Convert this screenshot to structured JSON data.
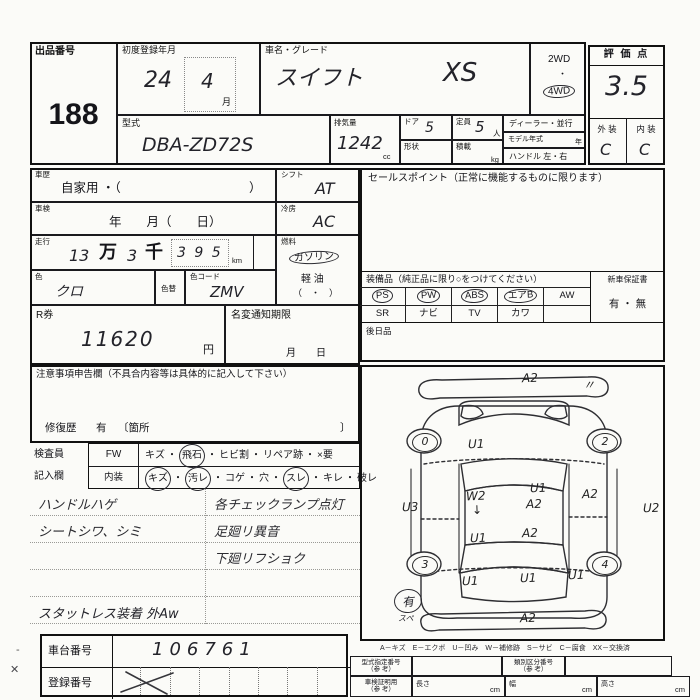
{
  "header": {
    "lot_label": "出品番号",
    "lot_number": "188",
    "first_reg_label": "初度登録年月",
    "first_reg_year": "24",
    "first_reg_month": "4",
    "month_suffix": "月",
    "name_grade_label": "車名・グレード",
    "car_name": "スイフト",
    "grade": "XS",
    "drive_2wd": "2WD",
    "drive_dot": "・",
    "drive_4wd": "4WD",
    "model_code_label": "型式",
    "model_code": "DBA-ZD72S",
    "displacement_label": "排気量",
    "displacement": "1242",
    "displacement_unit": "cc",
    "doors_label": "ドア",
    "doors": "5",
    "shape_label": "形状",
    "capacity_label": "定員",
    "capacity": "5",
    "capacity_unit": "人",
    "load_label": "積載",
    "load_unit": "kg",
    "dealer_label": "ディーラー・並行",
    "model_year_label": "モデル年式",
    "model_year_unit": "年",
    "handle_label": "ハンドル 左・右"
  },
  "score": {
    "title": "評 価 点",
    "value": "3.5",
    "exterior_label": "外 装",
    "interior_label": "内 装",
    "exterior": "C",
    "interior": "C"
  },
  "left": {
    "history_label": "車歴",
    "history_value": "自家用 ・（",
    "history_close": "）",
    "shaken_label": "車検",
    "shaken_value": "年　　月（　　日）",
    "mileage_label": "走行",
    "mileage_man": "13",
    "man_unit": "万",
    "mileage_sen": "3",
    "sen_unit": "千",
    "mileage_rest": "3 9 5",
    "km_unit": "km",
    "color_label": "色",
    "color_value": "クロ",
    "recolor_label": "色替",
    "color_code_label": "色コード",
    "color_code": "ZMV",
    "shift_label": "シフト",
    "shift_value": "AT",
    "ac_label": "冷房",
    "ac_value": "AC",
    "fuel_label": "燃料",
    "fuel_gasoline": "ガソリン",
    "fuel_diesel": "軽 油",
    "fuel_other": "（　・　）",
    "rticket_label": "R券",
    "rticket_value": "11620",
    "yen_unit": "円",
    "namechange_label": "名変通知期限",
    "namechange_value": "月　　日"
  },
  "sales": {
    "title": "セールスポイント（正常に機能するものに限ります）",
    "equipment_title": "装備品（純正品に限り○をつけてください）",
    "equipment_rows": [
      [
        {
          "label": "PS",
          "circled": true
        },
        {
          "label": "PW",
          "circled": true
        },
        {
          "label": "ABS",
          "circled": true
        },
        {
          "label": "エアB",
          "circled": true
        },
        {
          "label": "AW",
          "circled": false
        }
      ],
      [
        {
          "label": "SR",
          "circled": false
        },
        {
          "label": "ナビ",
          "circled": false
        },
        {
          "label": "TV",
          "circled": false
        },
        {
          "label": "カワ",
          "circled": false
        },
        {
          "label": "",
          "circled": false
        }
      ]
    ],
    "warranty_label": "新車保証書",
    "warranty_value": "有 ・ 無",
    "later_goods_label": "後日品"
  },
  "notice": {
    "title": "注意事項申告欄（不具合内容等は具体的に記入して下さい）",
    "repair_label": "修復歴",
    "repair_value": "有",
    "repair_open": "〔箇所",
    "repair_close": "〕"
  },
  "inspection": {
    "separator": "・",
    "row1_label": "検査員",
    "row1_key": "FW",
    "row1_items": [
      {
        "label": "キズ",
        "circled": false
      },
      {
        "label": "飛石",
        "circled": true
      },
      {
        "label": "ヒビ割",
        "circled": false
      },
      {
        "label": "リペア跡",
        "circled": false
      },
      {
        "label": "×要",
        "circled": false
      }
    ],
    "row2_label": "記入欄",
    "row2_key": "内装",
    "row2_items": [
      {
        "label": "キズ",
        "circled": true
      },
      {
        "label": "汚レ",
        "circled": true
      },
      {
        "label": "コゲ",
        "circled": false
      },
      {
        "label": "穴",
        "circled": false
      },
      {
        "label": "スレ",
        "circled": true
      },
      {
        "label": "キレ",
        "circled": false
      },
      {
        "label": "破レ",
        "circled": false
      }
    ]
  },
  "notes": {
    "left": [
      "ハンドルハゲ",
      "シートシワ、シミ"
    ],
    "right": [
      "各チェックランプ点灯",
      "足廻リ異音",
      "下廻リフショク"
    ],
    "tires": "スタットレス装着 外Aw"
  },
  "bottom": {
    "chassis_label": "車台番号",
    "chassis_value": "106761",
    "reg_label": "登録番号",
    "legend": "A－キズ　E－エクボ　U－凹み　W－補修跡　S－サビ　C－腐食　XX－交換済",
    "type_no_label": "型式指定番号",
    "class_no_label": "類別区分番号",
    "cert_label": "車検証明用",
    "ref_label": "（参 考）",
    "length_label": "長さ",
    "width_label": "幅",
    "height_label": "高さ",
    "cm_unit": "cm"
  },
  "margin": {
    "dash": "-",
    "cross": "✕"
  },
  "diagram": {
    "marks": [
      {
        "t": "A2",
        "x": 160,
        "y": 4
      },
      {
        "t": "〃",
        "x": 221,
        "y": 9
      },
      {
        "t": "U1",
        "x": 106,
        "y": 70
      },
      {
        "t": "U3",
        "x": 40,
        "y": 133
      },
      {
        "t": "W2",
        "x": 104,
        "y": 122
      },
      {
        "t": "↓",
        "x": 110,
        "y": 136
      },
      {
        "t": "U1",
        "x": 168,
        "y": 114
      },
      {
        "t": "A2",
        "x": 164,
        "y": 130
      },
      {
        "t": "A2",
        "x": 220,
        "y": 120
      },
      {
        "t": "U2",
        "x": 281,
        "y": 134
      },
      {
        "t": "U1",
        "x": 108,
        "y": 164
      },
      {
        "t": "A2",
        "x": 160,
        "y": 159
      },
      {
        "t": "U1",
        "x": 100,
        "y": 207
      },
      {
        "t": "U1",
        "x": 158,
        "y": 204
      },
      {
        "t": "U1",
        "x": 206,
        "y": 201
      },
      {
        "t": "A2",
        "x": 158,
        "y": 244
      }
    ],
    "wheels": [
      {
        "n": "0",
        "x": 50,
        "y": 66
      },
      {
        "n": "2",
        "x": 230,
        "y": 66
      },
      {
        "n": "3",
        "x": 50,
        "y": 189
      },
      {
        "n": "4",
        "x": 230,
        "y": 189
      }
    ],
    "spare": {
      "value": "有",
      "sub": "スペ"
    }
  }
}
